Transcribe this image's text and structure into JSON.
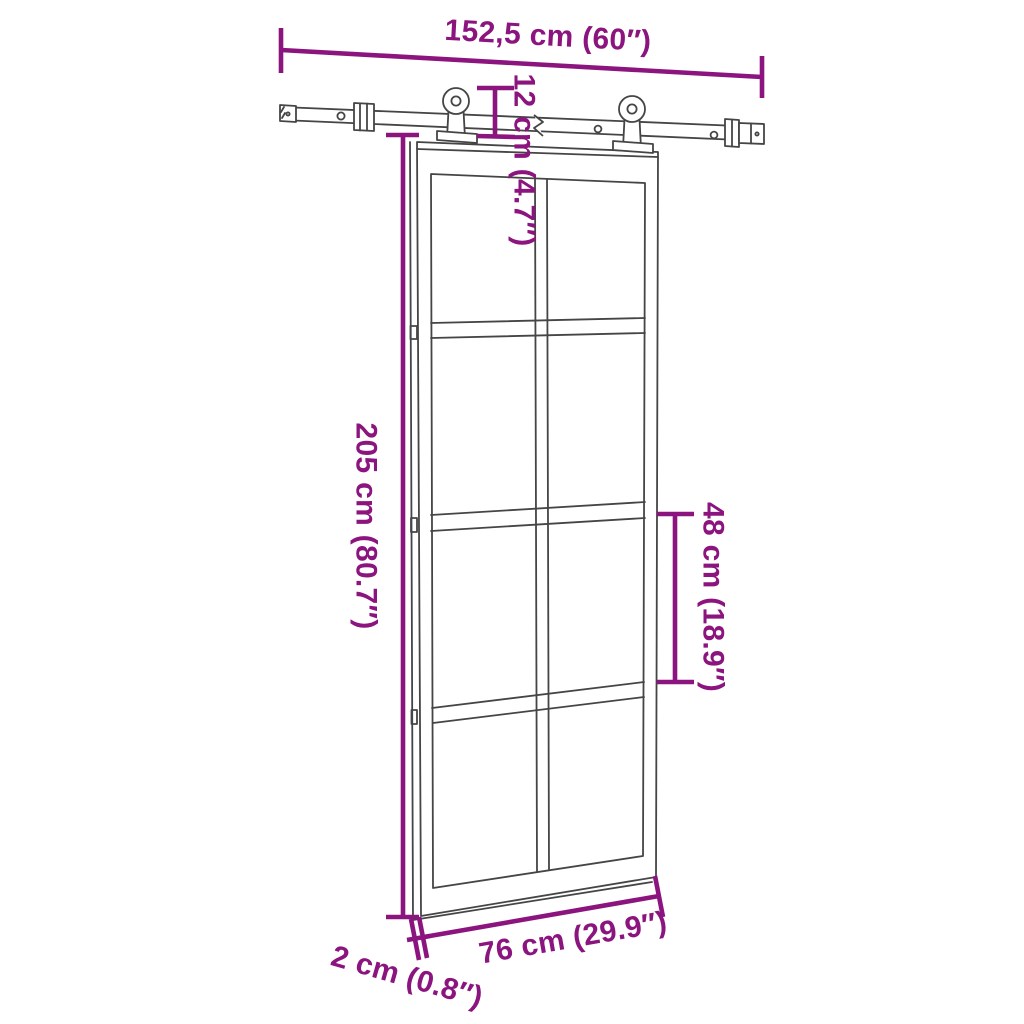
{
  "diagram": {
    "type": "product-dimension-diagram",
    "subject": "sliding glass barn door with overhead track hardware set",
    "colors": {
      "accent": "#8C147E",
      "line": "#454545",
      "background": "#FFFFFF"
    },
    "door": {
      "glass_panel_columns": 2,
      "glass_panel_rows": 4
    },
    "dimensions": {
      "track_length": "152,5 cm (60″)",
      "hanger_height": "12 cm (4.7″)",
      "door_height": "205 cm (80.7″)",
      "panel_height": "48 cm (18.9″)",
      "door_width": "76 cm (29.9″)",
      "door_thickness": "2 cm (0.8″)"
    }
  }
}
